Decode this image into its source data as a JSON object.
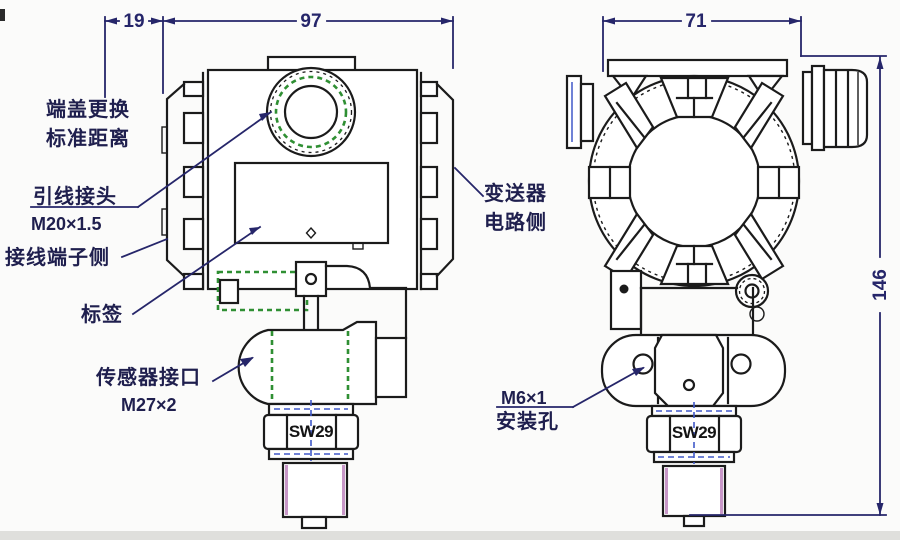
{
  "drawing": {
    "dimensions": {
      "cover_clearance": "19",
      "housing_width": "97",
      "front_width": "71",
      "total_height": "146"
    },
    "annotations": {
      "end_cover": {
        "line1": "端盖更换",
        "line2": "标准距离"
      },
      "lead_connector": {
        "name": "引线接头",
        "spec": "M20×1.5"
      },
      "terminal_side": "接线端子侧",
      "tag": "标签",
      "sensor_port": {
        "name": "传感器接口",
        "spec": "M27×2"
      },
      "circuit_side": {
        "line1": "变送器",
        "line2": "电路侧"
      },
      "mounting_hole": {
        "spec": "M6×1",
        "name": "安装孔"
      },
      "wrench_size_side": "SW29",
      "wrench_size_front": "SW29"
    },
    "colors": {
      "outline": "#1b1b1b",
      "dimension_navy": "#26266a",
      "hidden_green": "#2f8f33",
      "accent_pink": "#c897c8",
      "centerline_blue": "#4059c8",
      "background": "#fbfbfa"
    }
  }
}
